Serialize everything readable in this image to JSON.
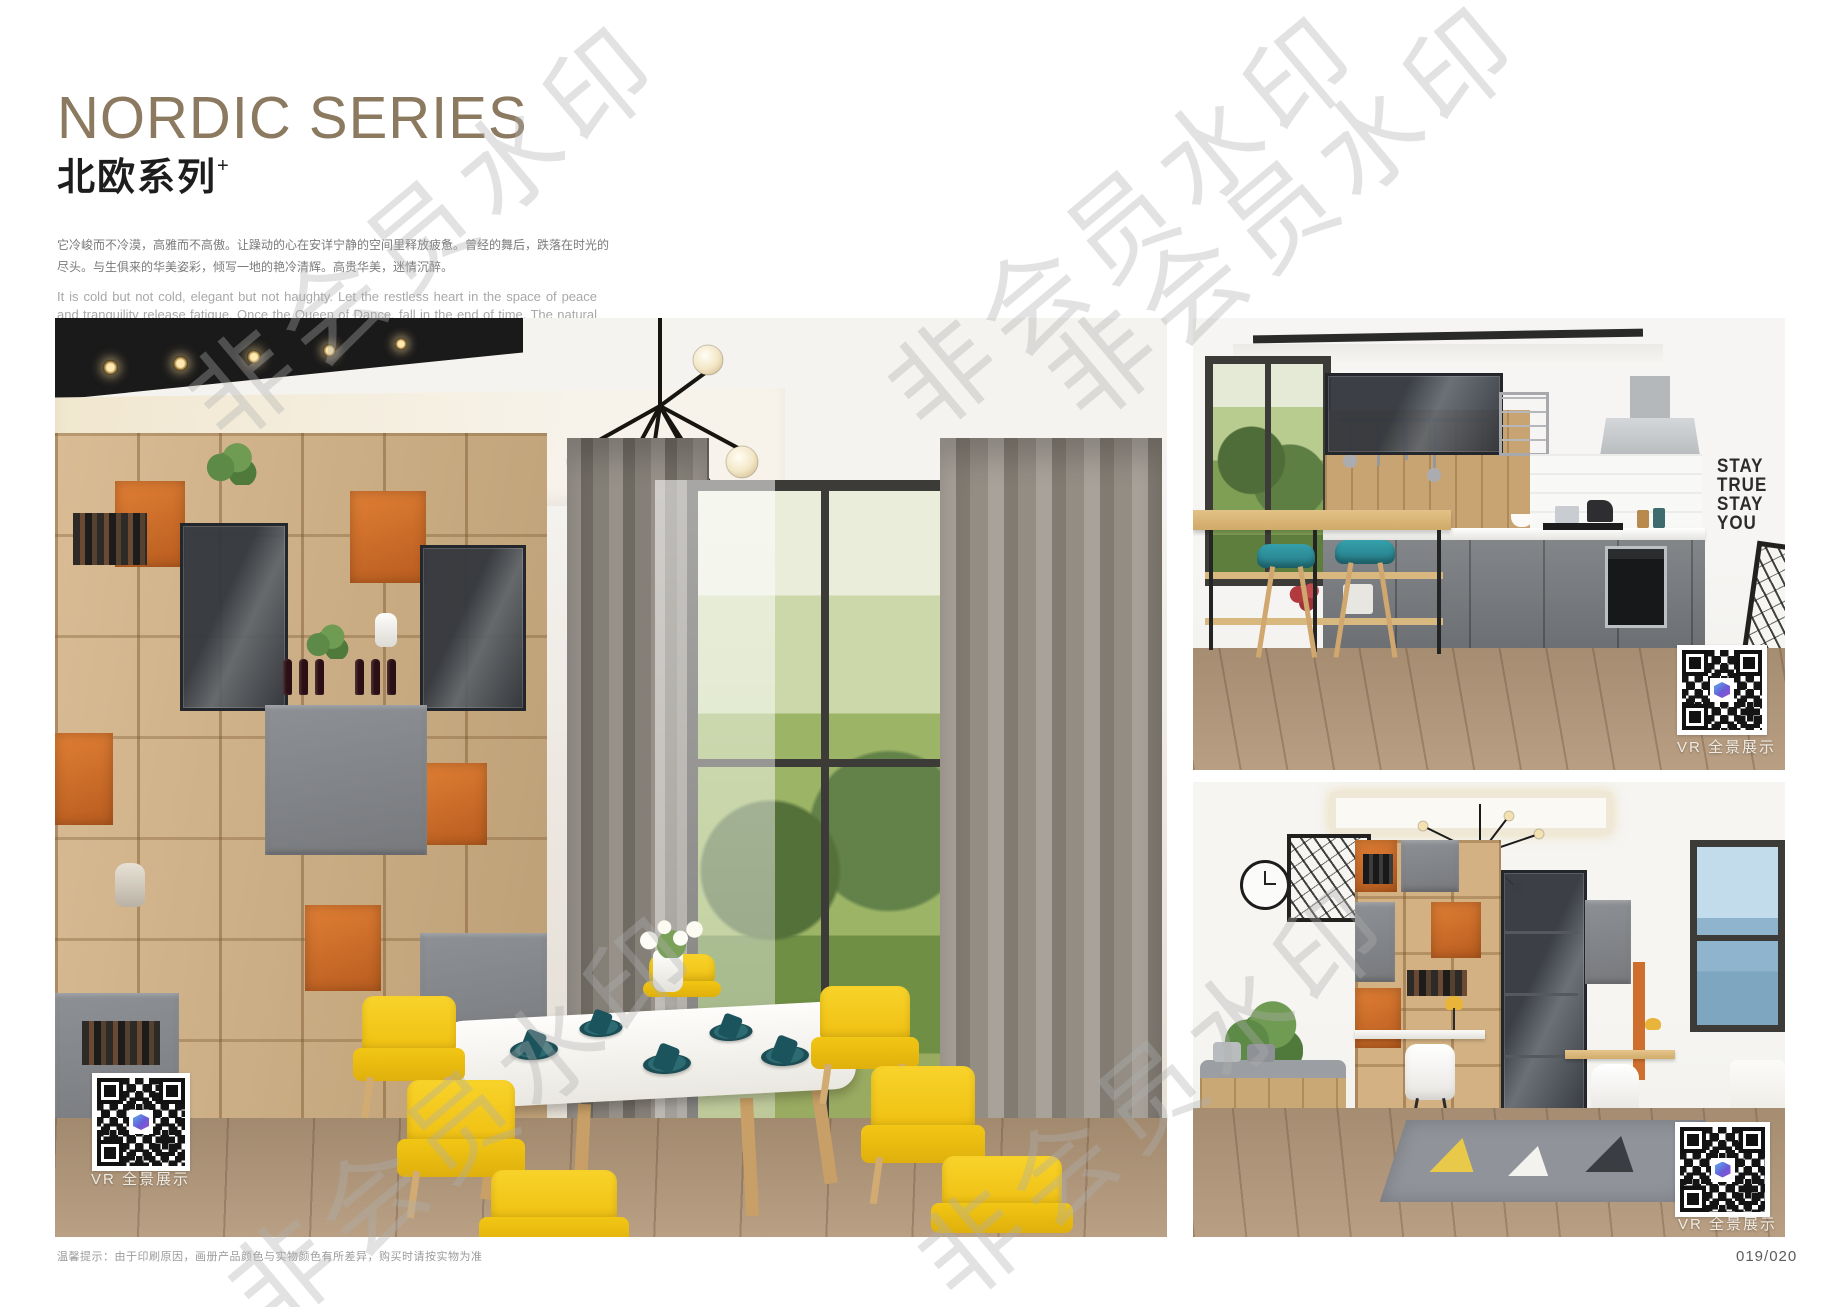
{
  "header": {
    "title_en": "NORDIC SERIES",
    "title_zh": "北欧系列",
    "title_plus": "+",
    "desc_zh": "它冷峻而不冷漠，高雅而不高傲。让躁动的心在安详宁静的空间里释放疲惫。曾经的舞后，跌落在时光的尽头。与生俱来的华美姿彩，倾写一地的艳冷清辉。高贵华美，迷情沉醉。",
    "desc_en": "It is cold but not cold, elegant but not haughty. Let the restless heart in the space of peace and tranquility release fatigue. Once the Queen of Dance, fall in the end of time. The natural beauty of the beautiful, pouring a land of cold and pure brilliance. Noble, beautiful, enchanted."
  },
  "watermark": {
    "text": "非会员水印"
  },
  "photos": {
    "vr_label": "VR 全景展示",
    "kitchen_wall_text": [
      "STAY",
      "TRUE",
      "STAY",
      "YOU"
    ]
  },
  "footer": {
    "note": "温馨提示：由于印刷原因，画册产品颜色与实物颜色有所差异，购买时请按实物为准",
    "page_number": "019/020"
  },
  "colors": {
    "title_accent": "#8c7a60",
    "chair_yellow": "#f5c91d",
    "cabinet_orange": "#cf6f2d",
    "stool_teal": "#2b8b96",
    "watermark_grey": "#aeaeae"
  }
}
